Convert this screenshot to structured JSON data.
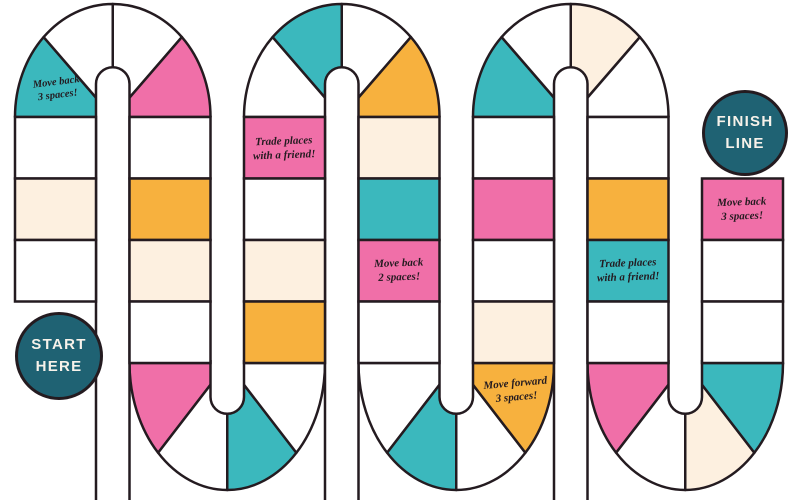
{
  "palette": {
    "teal": "#3bb8bd",
    "pink": "#f06fa8",
    "orange": "#f7b13e",
    "cream": "#fdf0e0",
    "white": "#ffffff",
    "outline": "#241b20",
    "badge": "#1f6273",
    "badge_text": "#f7f2ea"
  },
  "badges": {
    "start": {
      "line1": "START",
      "line2": "HERE"
    },
    "finish": {
      "line1": "FINISH",
      "line2": "LINE"
    }
  },
  "labels": {
    "l1": {
      "line1": "Move back",
      "line2": "3 spaces!"
    },
    "l2": {
      "line1": "Trade places",
      "line2": "with a friend!"
    },
    "l3": {
      "line1": "Move back",
      "line2": "2 spaces!"
    },
    "l4": {
      "line1": "Move forward",
      "line2": "3 spaces!"
    },
    "l5": {
      "line1": "Trade places",
      "line2": "with a friend!"
    },
    "l6": {
      "line1": "Move back",
      "line2": "3 spaces!"
    }
  },
  "board": {
    "columns": [
      {
        "spaces": [
          "white",
          "cream",
          "white",
          null
        ]
      },
      {
        "spaces": [
          "white",
          "orange",
          "cream",
          "white"
        ]
      },
      {
        "spaces": [
          "pink",
          "white",
          "cream",
          "orange"
        ]
      },
      {
        "spaces": [
          "cream",
          "teal",
          "pink",
          "white"
        ]
      },
      {
        "spaces": [
          "white",
          "pink",
          "white",
          "cream"
        ]
      },
      {
        "spaces": [
          "white",
          "orange",
          "teal",
          "white"
        ]
      },
      {
        "spaces": [
          null,
          "pink",
          "white",
          "white"
        ]
      }
    ],
    "arches": [
      {
        "wedges": [
          "teal",
          "white",
          "white",
          "pink"
        ]
      },
      {
        "wedges": [
          "white",
          "teal",
          "white",
          "orange"
        ]
      },
      {
        "wedges": [
          "teal",
          "white",
          "cream",
          "white"
        ]
      }
    ],
    "uturns": [
      {
        "wedges": [
          "pink",
          "white",
          "teal",
          "white"
        ]
      },
      {
        "wedges": [
          "white",
          "teal",
          "white",
          "orange"
        ]
      },
      {
        "wedges": [
          "pink",
          "white",
          "cream",
          "teal"
        ]
      }
    ]
  }
}
